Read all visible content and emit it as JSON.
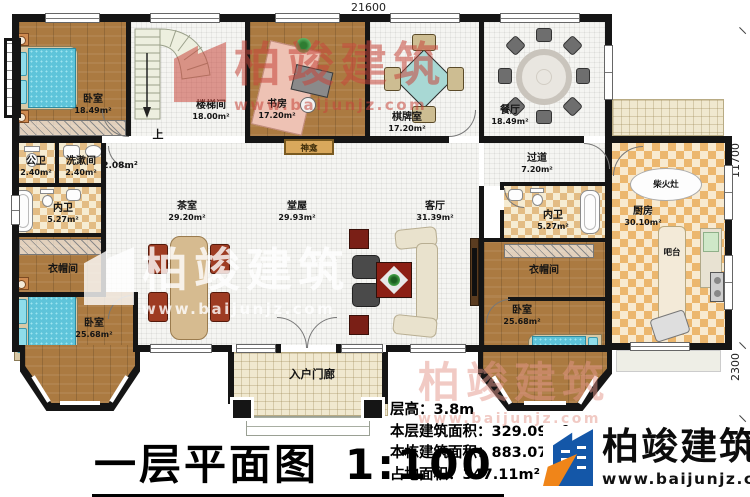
{
  "plan": {
    "title": "一层平面图",
    "scale": "1:100",
    "dims": {
      "top": "21600",
      "right_upper": "11700",
      "right_lower": "2300"
    },
    "info": [
      {
        "label": "层高：",
        "value": "3.8m"
      },
      {
        "label": "本层建筑面积：",
        "value": "329.09m²"
      },
      {
        "label": "本栋建筑面积：",
        "value": "883.07m²"
      },
      {
        "label": "占地面积：",
        "value": "347.11m²"
      }
    ]
  },
  "rooms": {
    "bedroom_tl": {
      "name": "卧室",
      "area": "18.49m²"
    },
    "stairwell": {
      "name": "楼梯间",
      "area": "18.00m²"
    },
    "study": {
      "name": "书房",
      "area": "17.20m²"
    },
    "chess_room": {
      "name": "棋牌室",
      "area": "17.20m²"
    },
    "dining_room": {
      "name": "餐厅",
      "area": "18.49m²"
    },
    "public_bath": {
      "name": "公卫",
      "area": "2.40m²"
    },
    "wash_room": {
      "name": "洗漱间",
      "area": "2.40m²"
    },
    "nook": {
      "area": "2.08m²"
    },
    "inner_bath_left": {
      "name": "内卫",
      "area": "5.27m²"
    },
    "cloakroom_left": {
      "name": "衣帽间"
    },
    "bedroom_bl": {
      "name": "卧室",
      "area": "25.68m²"
    },
    "tea_room": {
      "name": "茶室",
      "area": "29.20m²"
    },
    "main_hall": {
      "name": "堂屋",
      "area": "29.93m²"
    },
    "living_room": {
      "name": "客厅",
      "area": "31.39m²"
    },
    "passage": {
      "name": "过道",
      "area": "7.20m²"
    },
    "inner_bath_right": {
      "name": "内卫",
      "area": "5.27m²"
    },
    "cloakroom_right": {
      "name": "衣帽间"
    },
    "bedroom_br": {
      "name": "卧室",
      "area": "25.68m²"
    },
    "kitchen": {
      "name": "厨房",
      "area": "30.10m²"
    },
    "porch": {
      "name": "入户门廊"
    }
  },
  "annotations": {
    "up": "上",
    "shrine": "神龛",
    "bar_counter": "吧台",
    "wood_stove": "柴火灶"
  },
  "brand": {
    "name": "柏竣建筑",
    "url": "www.baijunjz.com"
  },
  "watermark": {
    "name": "柏竣建筑",
    "url": "www.baijunjz.com"
  },
  "colors": {
    "wall": "#151515",
    "wood_floor": "#ab7a41",
    "tile_tan": "#e3bc84",
    "tile_orange": "#ecb76e",
    "bed_blue": "#5ec4da",
    "brand_blue": "#1457a8",
    "brand_orange": "#f08519",
    "watermark_red": "#c6483c"
  }
}
